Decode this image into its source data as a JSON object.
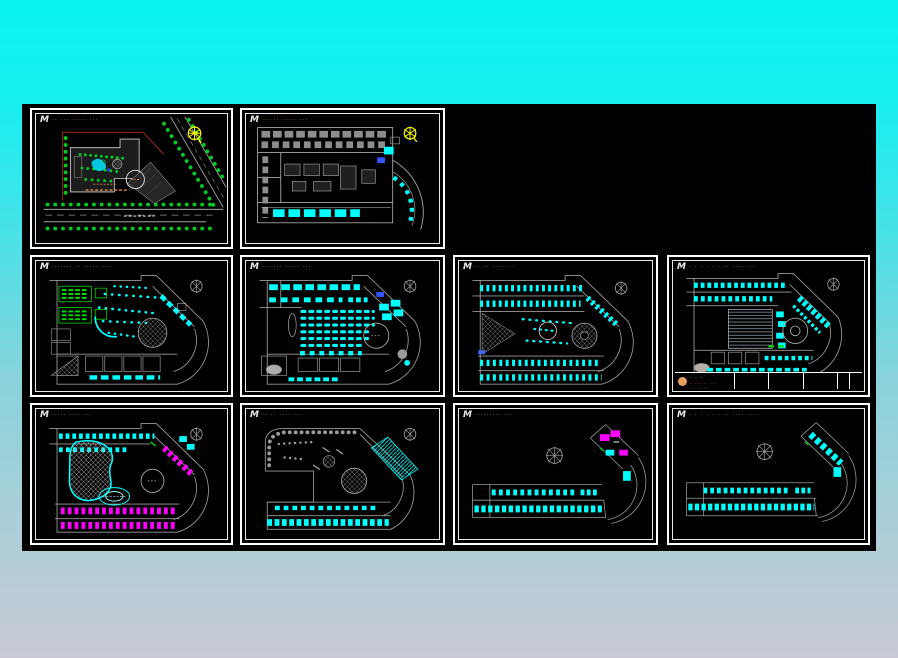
{
  "app": {
    "description_label": "cad-sheet-set-viewer",
    "background_top_color": "#09f3f3",
    "background_bottom_color": "#c9cad5",
    "canvas_color": "#000000"
  },
  "palette": {
    "sheet_border": "#ffffff",
    "wall_gray": "#9a9a9a",
    "furniture_cyan": "#00ffff",
    "landscape_green": "#00dd00",
    "bed_magenta": "#ff00ff",
    "compass_yellow": "#ffff00",
    "boundary_red": "#cc3322",
    "title_orange": "#c5783a"
  },
  "icons": {
    "north_compass_yellow": "compass-rosette-scribble",
    "north_compass_gray": "compass-rosette-cross"
  },
  "sheets": [
    {
      "key": "site-plan",
      "logo": "M",
      "title": "·· ···  ·····  ···"
    },
    {
      "key": "floor-plan-1",
      "logo": "M",
      "title": "··· ··  ·····  ···"
    },
    {
      "key": "floor-plan-2",
      "logo": "M",
      "title": "······· ··  ·····  ····"
    },
    {
      "key": "floor-plan-3",
      "logo": "M",
      "title": "··· ···  ·····  ···"
    },
    {
      "key": "floor-plan-4",
      "logo": "M",
      "title": "·· ·· ····  ···"
    },
    {
      "key": "floor-plan-5",
      "logo": "M",
      "title": "· · · · · ·  ·· ···· ···"
    },
    {
      "key": "floor-plan-6",
      "logo": "M",
      "title": "····· ····  ···"
    },
    {
      "key": "floor-plan-7",
      "logo": "M",
      "title": "·· ·· ····  ···"
    },
    {
      "key": "floor-plan-8",
      "logo": "M",
      "title": "·········  ···"
    },
    {
      "key": "floor-plan-9",
      "logo": "M",
      "title": "· · · · · ·  ·· ···· ····"
    }
  ],
  "titleblock": {
    "line1": "· · · · · · · · · · ·",
    "line2": "········ ··· ········"
  }
}
